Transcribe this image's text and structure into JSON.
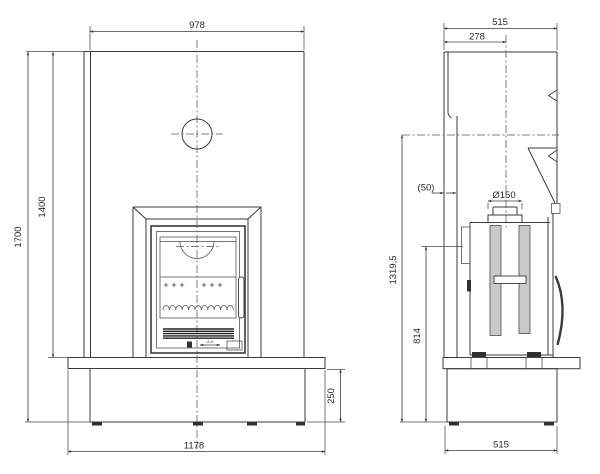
{
  "front": {
    "width_top": "978",
    "height_total": "1700",
    "height_opening": "1400",
    "height_base": "250",
    "width_base": "1178",
    "door_marking": "2-0"
  },
  "side": {
    "depth_total": "515",
    "flue_center_from_back": "278",
    "rear_gap": "(50)",
    "flue_diameter": "Ø150",
    "height_flue_line": "1319,5",
    "height_rear_detail": "814",
    "depth_base": "515"
  }
}
